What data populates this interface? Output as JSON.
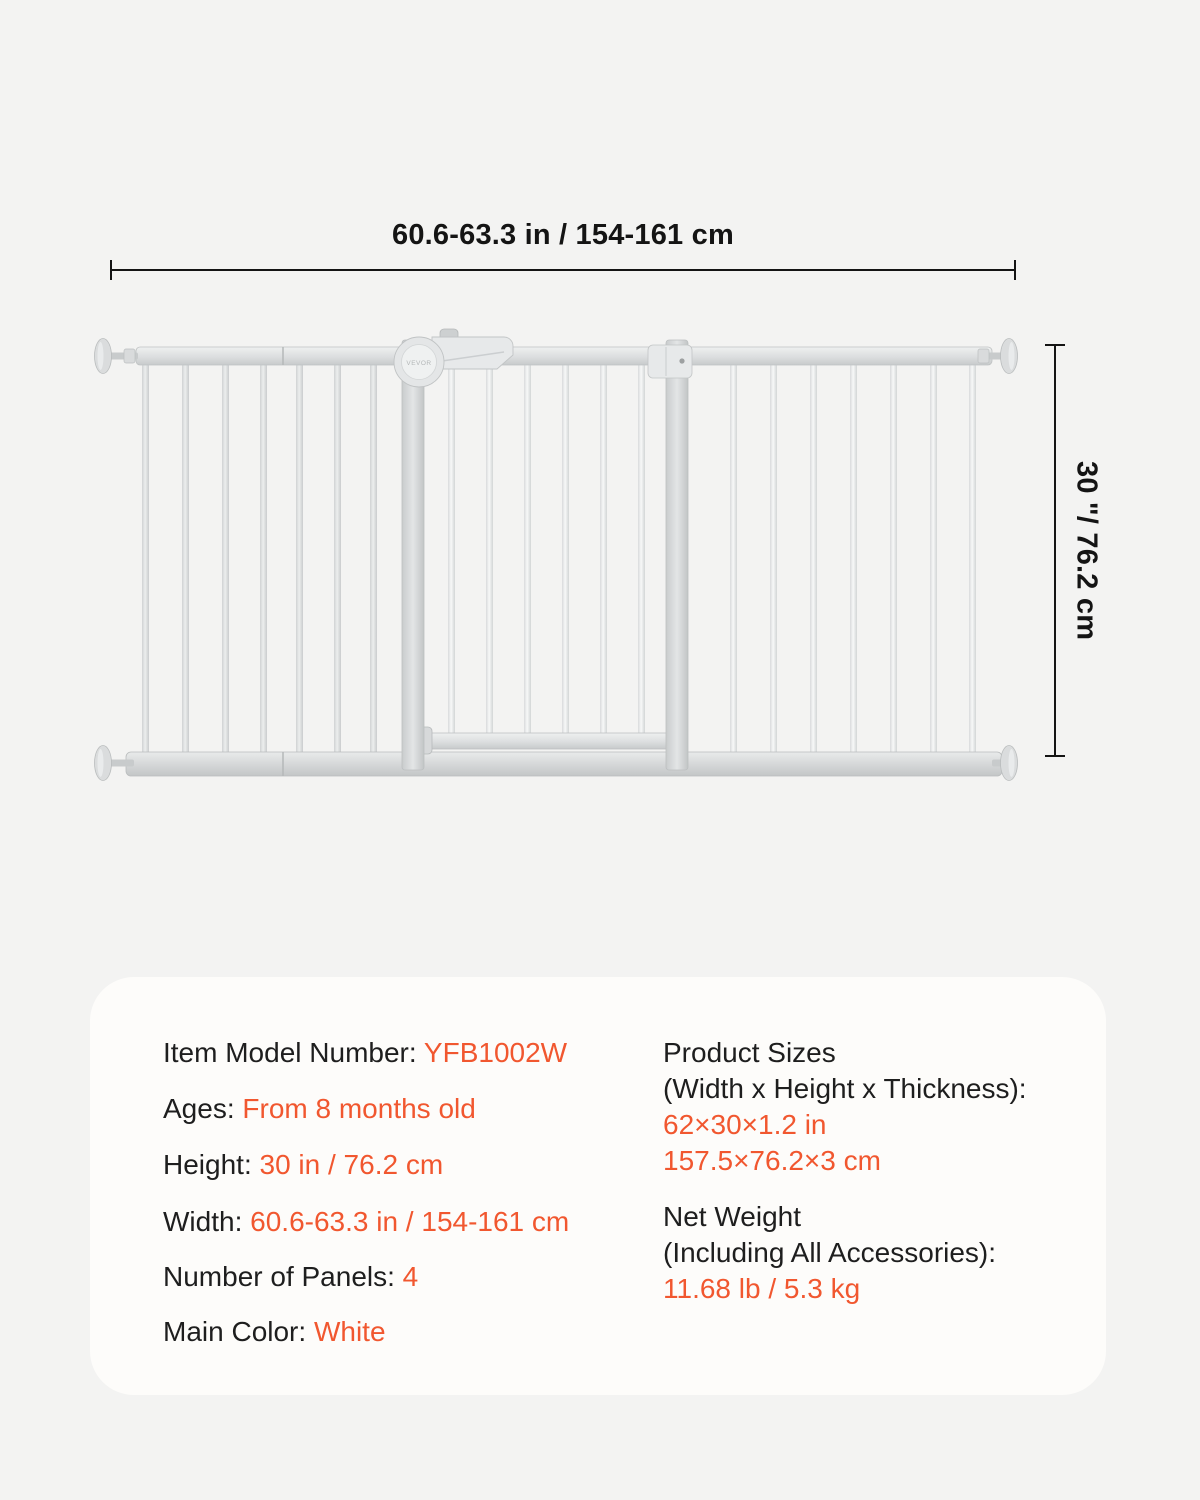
{
  "page": {
    "background_color": "#f3f3f2",
    "card_background": "#fdfcfa",
    "text_color": "#1e1e1e",
    "accent_color": "#f1572f"
  },
  "diagram": {
    "brand": "VEVOR",
    "width_dimension_label": "60.6-63.3 in / 154-161 cm",
    "height_dimension_label": "30 \"/ 76.2 cm"
  },
  "spec_card": {
    "left_rows": [
      {
        "label": "Item Model Number:",
        "value": "YFB1002W"
      },
      {
        "label": "Ages:",
        "value": "From 8 months old"
      },
      {
        "label": "Height:",
        "value": "30 in / 76.2 cm"
      },
      {
        "label": "Width:",
        "value": "60.6-63.3 in / 154-161 cm"
      },
      {
        "label": "Number of Panels:",
        "value": "4"
      },
      {
        "label": "Main Color:",
        "value": "White"
      }
    ],
    "right_blocks": [
      {
        "label_line1": "Product Sizes",
        "label_line2": "(Width x Height x Thickness):",
        "value_line1": "62×30×1.2 in",
        "value_line2": "157.5×76.2×3 cm"
      },
      {
        "label_line1": "Net Weight",
        "label_line2": "(Including All Accessories):",
        "value_line1": "11.68 lb / 5.3 kg"
      }
    ]
  }
}
